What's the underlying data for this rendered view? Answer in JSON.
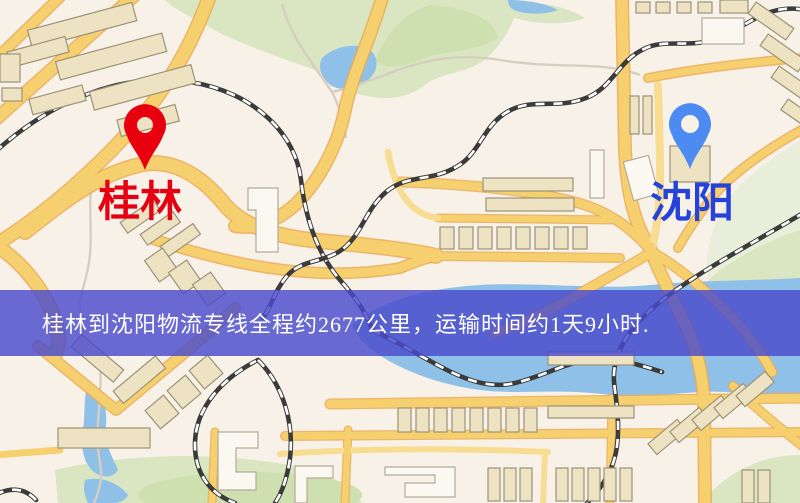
{
  "meta": {
    "type": "logistics-route-map",
    "width_px": 800,
    "height_px": 503
  },
  "markers": {
    "origin": {
      "label": "桂林",
      "pin": "red-map-pin"
    },
    "destination": {
      "label": "沈阳",
      "pin": "blue-map-pin"
    }
  },
  "banner": {
    "text": "桂林到沈阳物流专线全程约2677公里，运输时间约1天9小时."
  },
  "route_info": {
    "origin_city": "桂林",
    "destination_city": "沈阳",
    "distance_km": "2677",
    "duration": "1天9小时"
  },
  "theme": {
    "background": "#f7f1e8",
    "road": "#f6d06e",
    "road_casing": "#eaaa52",
    "road_minor": "#f8dc92",
    "building": "#ede3c3",
    "building_outline": "#9c9377",
    "park": "#d9e6c1",
    "water": "#8fc0e8",
    "railway": "#3b3b3b",
    "banner_bg": "rgba(74,74,204,0.82)",
    "banner_text": "#ffffff",
    "origin_pin": "#e8000f",
    "origin_label": "#e60012",
    "destination_pin": "#4b8bf2",
    "destination_label": "#2643d9"
  }
}
